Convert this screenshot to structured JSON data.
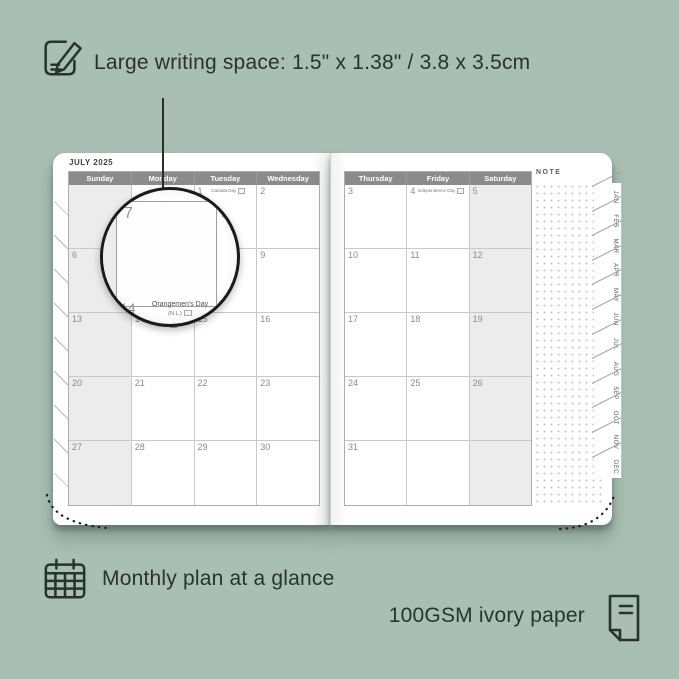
{
  "annotations": {
    "top_note": "Large writing space: 1.5\" x 1.38\" / 3.8 x 3.5cm",
    "bottom_left": "Monthly plan at a glance",
    "bottom_right": "100GSM ivory paper"
  },
  "planner": {
    "month_title": "JULY 2025",
    "note_label": "NOTE",
    "left_page": {
      "headers": [
        "Sunday",
        "Monday",
        "Tuesday",
        "Wednesday"
      ],
      "shaded_col": 0,
      "rows": [
        [
          {
            "day": ""
          },
          {
            "day": ""
          },
          {
            "day": "1",
            "holiday": "Canada Day"
          },
          {
            "day": "2"
          }
        ],
        [
          {
            "day": "6"
          },
          {
            "day": "7"
          },
          {
            "day": "8"
          },
          {
            "day": "9"
          }
        ],
        [
          {
            "day": "13"
          },
          {
            "day": "14",
            "holiday": "Orangemen's Day (N.L.)"
          },
          {
            "day": "15"
          },
          {
            "day": "16"
          }
        ],
        [
          {
            "day": "20"
          },
          {
            "day": "21"
          },
          {
            "day": "22"
          },
          {
            "day": "23"
          }
        ],
        [
          {
            "day": "27"
          },
          {
            "day": "28"
          },
          {
            "day": "29"
          },
          {
            "day": "30"
          }
        ]
      ]
    },
    "right_page": {
      "headers": [
        "Thursday",
        "Friday",
        "Saturday"
      ],
      "shaded_col": 2,
      "rows": [
        [
          {
            "day": "3"
          },
          {
            "day": "4",
            "holiday": "Independence Day"
          },
          {
            "day": "5"
          }
        ],
        [
          {
            "day": "10"
          },
          {
            "day": "11"
          },
          {
            "day": "12"
          }
        ],
        [
          {
            "day": "17"
          },
          {
            "day": "18"
          },
          {
            "day": "19"
          }
        ],
        [
          {
            "day": "24"
          },
          {
            "day": "25"
          },
          {
            "day": "26"
          }
        ],
        [
          {
            "day": "31"
          },
          {
            "day": ""
          },
          {
            "day": ""
          }
        ]
      ]
    },
    "month_tabs": [
      "JAN",
      "FEB",
      "MAR",
      "APR",
      "MAY",
      "JUN",
      "JUL",
      "AUG",
      "SEP",
      "OCT",
      "NOV",
      "DEC"
    ],
    "magnifier": {
      "day": "7",
      "next_day": "8",
      "below_day": "14",
      "holiday_name": "Orangemen's Day",
      "holiday_region": "(N.L.)"
    }
  },
  "colors": {
    "background": "#a9bfb4",
    "ink": "#27332f",
    "header_band": "#8b8b8b",
    "shaded_cell": "#ececec",
    "grid_line": "#c9c9c9",
    "day_number": "#8a8a8a"
  }
}
